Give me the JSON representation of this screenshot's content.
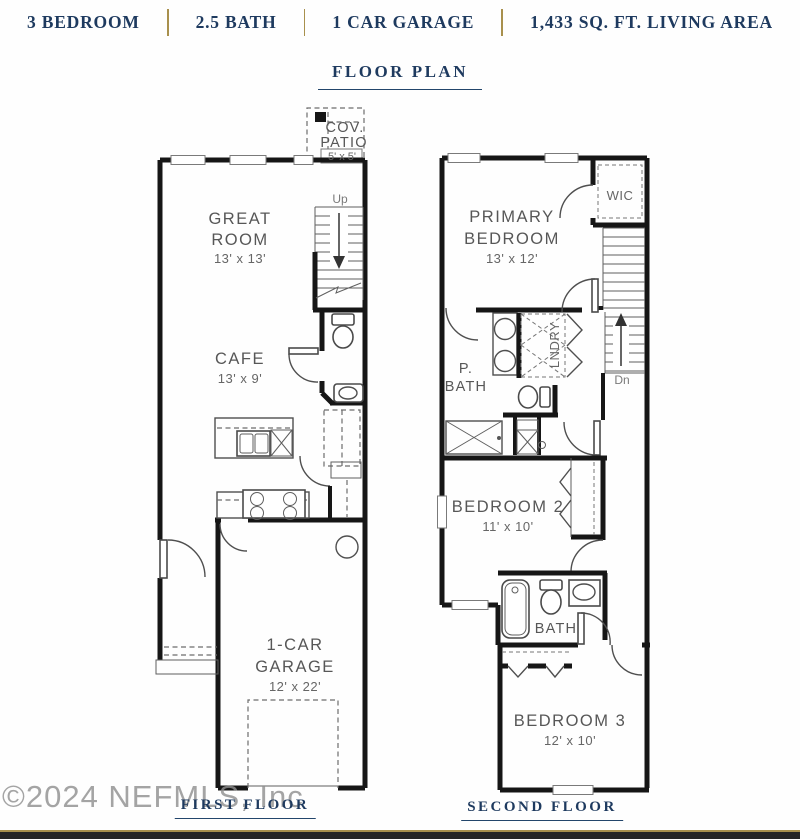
{
  "header": {
    "specs": [
      "3 BEDROOM",
      "2.5 BATH",
      "1 CAR GARAGE",
      "1,433 SQ. FT. LIVING AREA"
    ],
    "title": "FLOOR PLAN"
  },
  "first_floor": {
    "label": "FIRST FLOOR",
    "cov_patio": {
      "line1": "COV.",
      "line2": "PATIO",
      "dims": "5' x 5'"
    },
    "great_room": {
      "line1": "GREAT",
      "line2": "ROOM",
      "dims": "13' x 13'"
    },
    "cafe": {
      "name": "CAFE",
      "dims": "13' x 9'"
    },
    "garage": {
      "line1": "1-CAR",
      "line2": "GARAGE",
      "dims": "12' x 22'"
    },
    "stair_direction": "Up"
  },
  "second_floor": {
    "label": "SECOND FLOOR",
    "primary_bedroom": {
      "line1": "PRIMARY",
      "line2": "BEDROOM",
      "dims": "13' x 12'"
    },
    "wic": "WIC",
    "laundry": "LNDRY",
    "primary_bath": {
      "line1": "P.",
      "line2": "BATH"
    },
    "bedroom2": {
      "name": "BEDROOM 2",
      "dims": "11' x 10'"
    },
    "bath": "BATH",
    "bedroom3": {
      "name": "BEDROOM 3",
      "dims": "12' x 10'"
    },
    "stair_direction": "Dn"
  },
  "watermark": "©2024 NEFMLS, Inc",
  "colors": {
    "navy": "#1e3a5f",
    "gold": "#a8904d",
    "wall": "#161616",
    "label_gray": "#5a5a5a"
  }
}
